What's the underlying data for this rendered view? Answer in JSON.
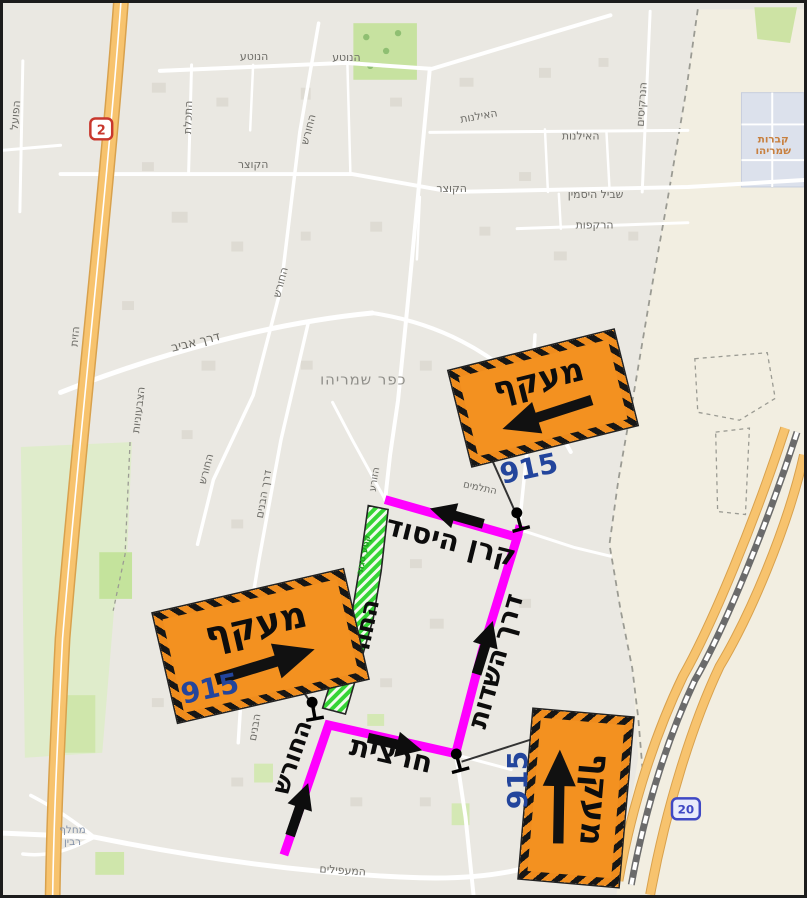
{
  "map": {
    "town_label": "כפר שמריהו",
    "sign_label": "מעקף",
    "sign_route_number": "915",
    "closed_section_text": "קטע סגור",
    "route_shields": {
      "highway_2": "2",
      "road_20": "20"
    },
    "bold_street_labels": {
      "keren_hayesod": "קרן היסוד",
      "derech_hasadot": "דרך השדות",
      "hachoresh_upper": "החורש",
      "hachoresh_lower": "החורש",
      "chartzit": "חרצית"
    },
    "street_labels": {
      "hapoel": "הפועל",
      "hanotea_w": "הנוטע",
      "hanotea_e": "הנוטע",
      "hatchelet": "התכלת",
      "hakotzer_w": "הקוצר",
      "hakotzer_e": "הקוצר",
      "hachoresh_n1": "החורש",
      "hachoresh_n2": "החורש",
      "hachoresh_c": "החורש",
      "hailanot_w": "האילנות",
      "hailanot_e": "האילנות",
      "hanarkisim": "הנרקיסים",
      "shvil_hayasmin": "שביל היסמין",
      "harakafot": "הרקפות",
      "hazayit": "הזית",
      "derech_aviv": "דרך אביב",
      "hatzivoniyot": "הצבעוניות",
      "derech_habanim": "דרך הבנים",
      "habanim": "הבנים",
      "hazorea": "הזורע",
      "hatlamim": "התלמים",
      "hamaapilim": "המעפילים"
    },
    "area_labels": {
      "cemetery_line1": "קברות",
      "cemetery_line2": "שמריהו",
      "interchange_line1": "מחלף",
      "interchange_line2": "רבין"
    }
  }
}
